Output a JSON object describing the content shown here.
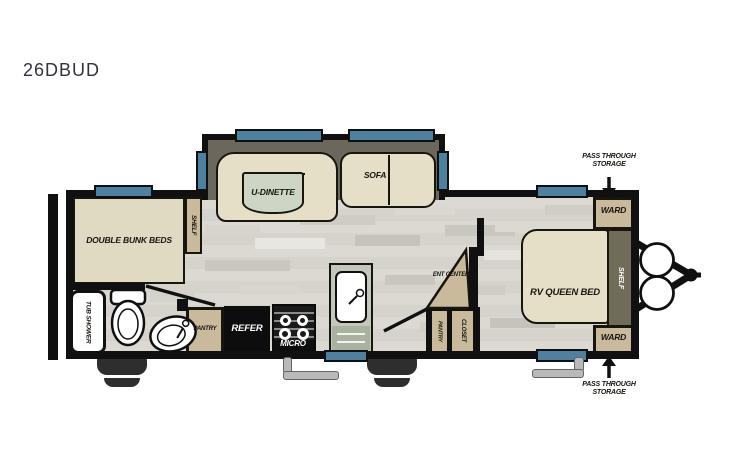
{
  "title": "26DBUD",
  "floorplan": {
    "slide_out": {
      "u_dinette": "U-DINETTE",
      "sofa": "SOFA"
    },
    "bunk_room": {
      "bed_label": "DOUBLE BUNK BEDS",
      "shelf": "SHELF"
    },
    "bathroom": {
      "tub_shower": "TUB SHOWER"
    },
    "kitchen": {
      "pantry": "PANTRY",
      "refer": "REFER",
      "micro": "MICRO"
    },
    "hall": {
      "ent_center": "ENT CENTER",
      "pantry": "PANTRY",
      "closet": "CLOSET"
    },
    "bedroom": {
      "bed_label": "RV QUEEN BED",
      "ward_top": "WARD",
      "ward_bottom": "WARD",
      "shelf": "SHELF"
    },
    "front": {
      "pass_through_top": "PASS THROUGH STORAGE",
      "pass_through_bottom": "PASS THROUGH STORAGE"
    }
  },
  "colors": {
    "wall": "#101010",
    "window": "#4e81a0",
    "furniture": "#e6dfc8",
    "cabinet": "#c9ba9b",
    "slide_interior": "#6b675c",
    "dark_shelf": "#716c58",
    "dinette_table": "#cdd5c5",
    "counter": "#c3c8ba"
  }
}
